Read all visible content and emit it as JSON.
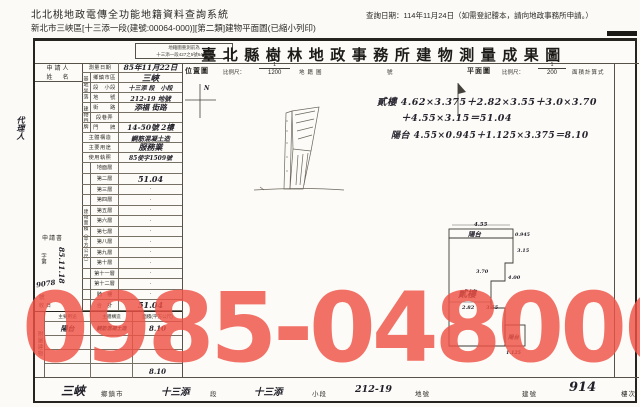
{
  "page_header": {
    "system_title": "北北桃地政電傳全功能地籍資料查詢系統",
    "query_date": "查詢日期：114年11月24日（如需登記謄本，請向地政事務所申請。）",
    "subtitle": "新北市三峽區[十三添一段(建號:00064-000)][第二類]建物平面圖(已縮小列印)",
    "margin_note": "代理人"
  },
  "doc": {
    "title": "臺北縣樹林地政事務所建物測量成果圖",
    "stamp_line1": "地籍圖重測前為",
    "stamp_line2": "十三添一段427之5號64建號",
    "applicant_label1": "申請人",
    "applicant_label2": "姓　名",
    "application": {
      "book": "申請書",
      "zi_di": "字第",
      "num": "9078",
      "hao": "號",
      "shou_ri": "收日",
      "date": "85.11.18"
    },
    "group_site": "基地坐落",
    "group_address": "建物門牌",
    "info_rows": [
      {
        "label": "測量日期",
        "value": "85年11月22日"
      },
      {
        "label": "鄉鎮市區",
        "value": "三峽"
      },
      {
        "label": "段　小段",
        "value": "十三添 段　小段"
      },
      {
        "label": "地　　號",
        "value": "212-19 地號"
      },
      {
        "label": "街　　路",
        "value": "添福 街路"
      },
      {
        "label": "段巷弄",
        "value": ""
      },
      {
        "label": "門　　牌",
        "value": "14-50號 2樓"
      },
      {
        "label": "主體構造",
        "value": "鋼筋混凝土造"
      },
      {
        "label": "主要用途",
        "value": "服務業"
      },
      {
        "label": "使用執照",
        "value": "85使字1509號"
      }
    ],
    "floor_group": "建物面積（平方公尺）",
    "floors": [
      {
        "label": "地面層",
        "value": ""
      },
      {
        "label": "第二層",
        "value": "51.04"
      },
      {
        "label": "第三層",
        "value": "·"
      },
      {
        "label": "第四層",
        "value": "·"
      },
      {
        "label": "第五層",
        "value": "·"
      },
      {
        "label": "第六層",
        "value": "·"
      },
      {
        "label": "第七層",
        "value": "·"
      },
      {
        "label": "第八層",
        "value": "·"
      },
      {
        "label": "第九層",
        "value": "·"
      },
      {
        "label": "第十層",
        "value": "·"
      },
      {
        "label": "第十一層",
        "value": "·"
      },
      {
        "label": "第十二層",
        "value": "·"
      },
      {
        "label": "騎　樓",
        "value": "·"
      },
      {
        "label": "合　計",
        "value": "51.04"
      }
    ],
    "annex": {
      "group": "附屬建物",
      "headers": [
        "主要用途",
        "主體構造",
        "面積(平方公尺)"
      ],
      "rows": [
        [
          "陽台",
          "鋼筋混凝土造",
          "8.10"
        ],
        [
          "",
          "",
          ""
        ],
        [
          "",
          "",
          ""
        ],
        [
          "",
          "",
          "8.10"
        ]
      ]
    },
    "location": {
      "title": "位置圖",
      "scale_label": "比例尺：",
      "num": "1",
      "den": "1200",
      "note1": "地籍圖",
      "note2": "號",
      "north": "N"
    },
    "plan": {
      "title": "平面圖",
      "scale_label": "比例尺：",
      "num": "1",
      "den": "200",
      "note": "面積計算式",
      "calc1": "貳樓 4.62×3.375＋2.82×3.55＋3.0×3.70",
      "calc2": "＋4.55×3.15＝51.04",
      "calc3": "陽台 4.55×0.945＋1.125×3.375＝8.10",
      "room": "貳樓",
      "balcony": "陽台",
      "balcony2": "陽台",
      "d_top": "4.55",
      "d_r1": "0.945",
      "d_r2": "3.15",
      "d_l": "3.70",
      "d_m": "4.00",
      "d_b1": "2.82",
      "d_b2": "3.55",
      "d_s": "1.125"
    },
    "footer": [
      {
        "value": "三峽",
        "label": "鄉鎮市"
      },
      {
        "value": "十三添",
        "label": "段"
      },
      {
        "value": "十三添",
        "label": "小段"
      },
      {
        "value": "212-19",
        "label": "地號"
      },
      {
        "value": "",
        "label": "建號"
      },
      {
        "value": "914",
        "label": "樓次"
      }
    ]
  },
  "watermark": "0985-048006"
}
